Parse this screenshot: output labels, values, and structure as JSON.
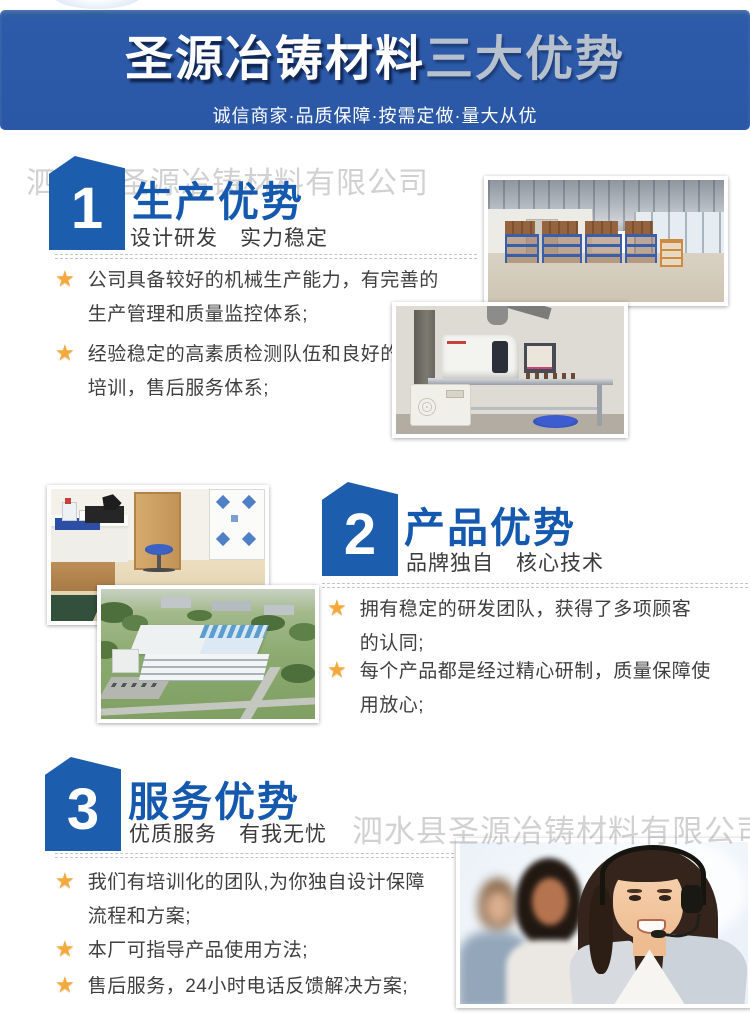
{
  "watermark": {
    "text": "泗水县圣源冶铸材料有限公司"
  },
  "banner": {
    "title_brand": "圣源冶铸材料",
    "title_suffix": "三大优势",
    "subtitle": "诚信商家·品质保障·按需定做·量大从优",
    "bg_color": "#2b58a6"
  },
  "icons": {
    "star": "★"
  },
  "colors": {
    "badge_blue": "#1d5dad",
    "title_blue": "#1459ae",
    "star_gold": "#f3a93c",
    "body_text": "#3f3f3f"
  },
  "sections": [
    {
      "number": "1",
      "title": "生产优势",
      "subtitle": "设计研发　实力稳定",
      "bullets": [
        "公司具备较好的机械生产能力，有完善的生产管理和质量监控体系;",
        "经验稳定的高素质检测队伍和良好的上岗培训，售后服务体系;"
      ],
      "photos": [
        "warehouse-racks",
        "testing-instrument"
      ]
    },
    {
      "number": "2",
      "title": "产品优势",
      "subtitle": "品牌独自　核心技术",
      "bullets": [
        "拥有稳定的研发团队，获得了多项顾客的认同;",
        "每个产品都是经过精心研制，质量保障使用放心;"
      ],
      "photos": [
        "laboratory-room",
        "factory-aerial-view"
      ]
    },
    {
      "number": "3",
      "title": "服务优势",
      "subtitle": "优质服务　有我无忧",
      "bullets": [
        "我们有培训化的团队,为你独自设计保障流程和方案;",
        "本厂可指导产品使用方法;",
        "售后服务，24小时电话反馈解决方案;"
      ],
      "photos": [
        "customer-service-team"
      ]
    }
  ]
}
